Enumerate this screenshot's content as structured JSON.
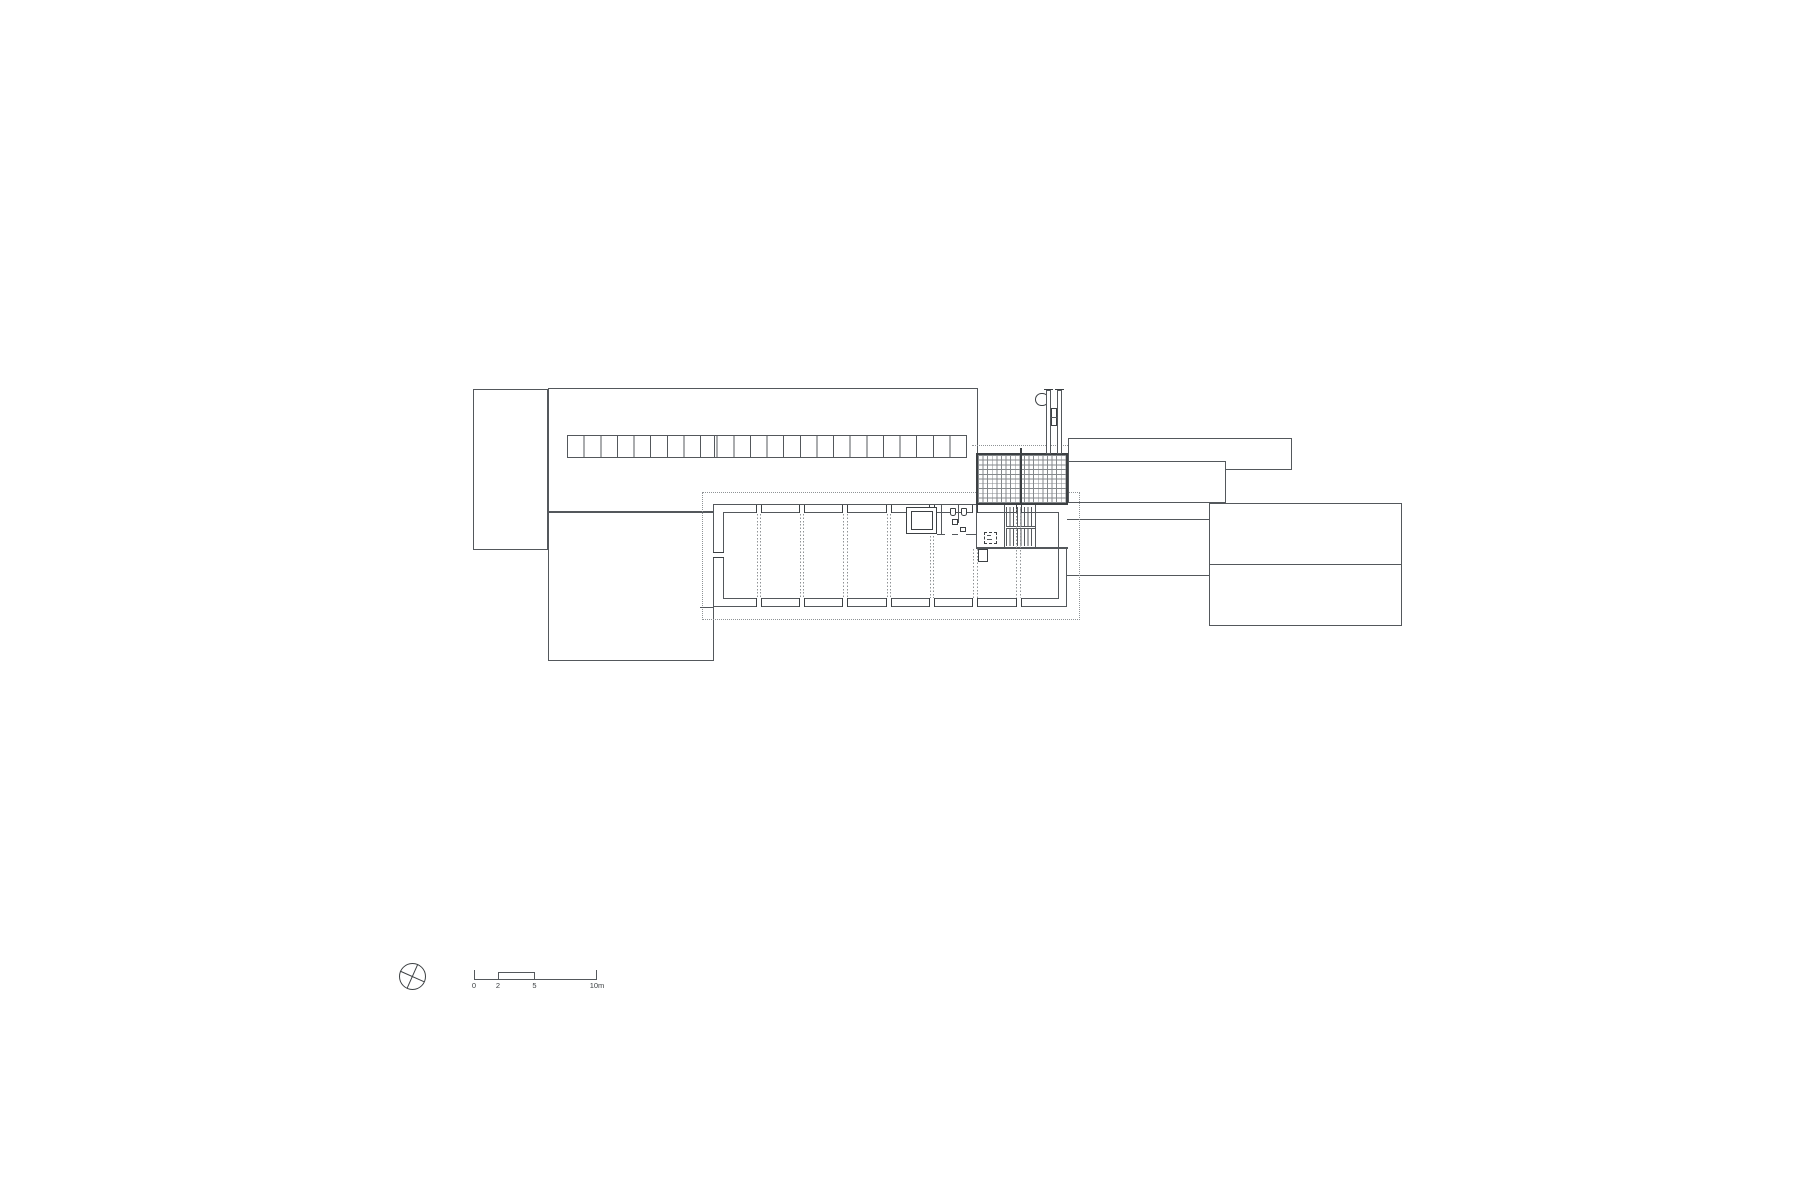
{
  "canvas": {
    "width": 1800,
    "height": 1200,
    "background": "#ffffff"
  },
  "colors": {
    "paper": "#ffffff",
    "line": "#54585c",
    "dark": "#3c4043",
    "dot": "#8f9396",
    "grid": "#85898c"
  },
  "scale_bar": {
    "labels": [
      "0",
      "2",
      "5",
      "10m"
    ]
  },
  "elements": [
    {
      "n": "annex-north-west",
      "t": "rect",
      "x": 473,
      "y": 389,
      "w": 75,
      "h": 161
    },
    {
      "n": "hall-north",
      "t": "rect",
      "x": 548,
      "y": 388,
      "w": 430,
      "h": 124
    },
    {
      "n": "wing-south-west",
      "t": "rect",
      "x": 548,
      "y": 512,
      "w": 166,
      "h": 149
    },
    {
      "n": "strip-north-east",
      "t": "rect",
      "x": 1068,
      "y": 438,
      "w": 224,
      "h": 32
    },
    {
      "n": "link-east",
      "t": "rect",
      "x": 1068,
      "y": 461,
      "w": 158,
      "h": 42
    },
    {
      "n": "building-east",
      "t": "rect",
      "x": 1209,
      "y": 503,
      "w": 193,
      "h": 123
    },
    {
      "n": "building-east-divider",
      "t": "fill",
      "x": 1209,
      "y": 563.5,
      "w": 193,
      "h": 1.2
    },
    {
      "n": "corridor-north-edge",
      "t": "fill",
      "x": 1067,
      "y": 519,
      "w": 142,
      "h": 1.2
    },
    {
      "n": "corridor-south-edge",
      "t": "fill",
      "x": 1067,
      "y": 574.5,
      "w": 142,
      "h": 1.2
    },
    {
      "n": "upper-floor-dashed-outline",
      "t": "dashrect",
      "x": 702,
      "y": 492,
      "w": 378,
      "h": 128
    },
    {
      "n": "hall-south-wall-extension",
      "t": "fill",
      "x": 700,
      "y": 607,
      "w": 14,
      "h": 1
    },
    {
      "n": "floor-plan-outer-wall",
      "t": "rect",
      "x": 713,
      "y": 504,
      "w": 354,
      "h": 103
    },
    {
      "n": "floor-plan-inner-wall",
      "t": "rect",
      "x": 723,
      "y": 512,
      "w": 336,
      "h": 87
    },
    {
      "n": "wall-patch-north",
      "t": "patch",
      "x": 905.5,
      "y": 505,
      "w": 161,
      "h": 6.5
    },
    {
      "n": "wall-patch-east",
      "t": "patch",
      "x": 1058.5,
      "y": 505,
      "w": 8,
      "h": 42
    },
    {
      "n": "column-mark",
      "t": "colv",
      "x": 755.8,
      "y": 504.5,
      "w": 6,
      "h": 8.5
    },
    {
      "n": "column-mark",
      "t": "colv",
      "x": 799.1,
      "y": 504.5,
      "w": 6,
      "h": 8.5
    },
    {
      "n": "column-mark",
      "t": "colv",
      "x": 842.4,
      "y": 504.5,
      "w": 6,
      "h": 8.5
    },
    {
      "n": "column-mark",
      "t": "colv",
      "x": 885.7,
      "y": 504.5,
      "w": 6,
      "h": 8.5
    },
    {
      "n": "column-mark",
      "t": "colv",
      "x": 929,
      "y": 504.5,
      "w": 6,
      "h": 8.5
    },
    {
      "n": "column-mark",
      "t": "colv",
      "x": 972.3,
      "y": 504.5,
      "w": 6,
      "h": 8.5
    },
    {
      "n": "column-mark",
      "t": "colv",
      "x": 1015.6,
      "y": 504.5,
      "w": 6,
      "h": 8.5
    },
    {
      "n": "column-mark",
      "t": "colv",
      "x": 755.8,
      "y": 598,
      "w": 6,
      "h": 8.5
    },
    {
      "n": "column-mark",
      "t": "colv",
      "x": 799.1,
      "y": 598,
      "w": 6,
      "h": 8.5
    },
    {
      "n": "column-mark",
      "t": "colv",
      "x": 842.4,
      "y": 598,
      "w": 6,
      "h": 8.5
    },
    {
      "n": "column-mark",
      "t": "colv",
      "x": 885.7,
      "y": 598,
      "w": 6,
      "h": 8.5
    },
    {
      "n": "column-mark",
      "t": "colv",
      "x": 929,
      "y": 598,
      "w": 6,
      "h": 8.5
    },
    {
      "n": "column-mark",
      "t": "colv",
      "x": 972.3,
      "y": 598,
      "w": 6,
      "h": 8.5
    },
    {
      "n": "column-mark",
      "t": "colv",
      "x": 1015.6,
      "y": 598,
      "w": 6,
      "h": 8.5
    },
    {
      "n": "column-mark-west",
      "t": "colh",
      "x": 713,
      "y": 551.5,
      "w": 10.5,
      "h": 6
    },
    {
      "n": "elevator-shaft-outer",
      "t": "rectb",
      "x": 906,
      "y": 507,
      "w": 31,
      "h": 27
    },
    {
      "n": "elevator-shaft-inner",
      "t": "rectb",
      "x": 910.5,
      "y": 511,
      "w": 22,
      "h": 19
    },
    {
      "n": "wall-elevator-toilet",
      "t": "fill",
      "x": 940.5,
      "y": 505,
      "w": 1.2,
      "h": 29
    },
    {
      "n": "toilet-partition",
      "t": "fill",
      "x": 957.5,
      "y": 505,
      "w": 1.2,
      "h": 18
    },
    {
      "n": "wc-fixture",
      "t": "wc",
      "x": 949.5,
      "y": 507.5,
      "w": 6,
      "h": 8
    },
    {
      "n": "wc-fixture",
      "t": "wc",
      "x": 961,
      "y": 507.5,
      "w": 6,
      "h": 8
    },
    {
      "n": "sink-fixture",
      "t": "sq",
      "x": 951.5,
      "y": 518.5,
      "w": 6.5,
      "h": 6
    },
    {
      "n": "sink-fixture",
      "t": "sq",
      "x": 959.5,
      "y": 526.5,
      "w": 6.5,
      "h": 5
    },
    {
      "n": "toilet-south-wall",
      "t": "fill",
      "x": 937,
      "y": 533.5,
      "w": 7.5,
      "h": 1.2
    },
    {
      "n": "toilet-south-wall",
      "t": "fill",
      "x": 951.5,
      "y": 533.5,
      "w": 6.5,
      "h": 1.2
    },
    {
      "n": "toilet-south-wall",
      "t": "fill",
      "x": 966,
      "y": 533.5,
      "w": 10.5,
      "h": 1.2
    },
    {
      "n": "lobby-west-wall",
      "t": "fill",
      "x": 976,
      "y": 505,
      "w": 1.4,
      "h": 43
    },
    {
      "n": "service-south-wall",
      "t": "fill",
      "x": 976,
      "y": 546.5,
      "w": 91.5,
      "h": 2.4
    },
    {
      "n": "wall-stub",
      "t": "rectb",
      "x": 977.5,
      "y": 549,
      "w": 10.5,
      "h": 13
    },
    {
      "n": "shaft-symbol-dashed",
      "t": "dashsm",
      "x": 984,
      "y": 532,
      "w": 13,
      "h": 12
    },
    {
      "n": "shaft-symbol-mark",
      "t": "fill",
      "x": 986.5,
      "y": 535,
      "w": 4,
      "h": 1.1
    },
    {
      "n": "shaft-symbol-mark",
      "t": "fill",
      "x": 986.5,
      "y": 538.5,
      "w": 5,
      "h": 1.1
    },
    {
      "n": "stair-wall-west",
      "t": "fill",
      "x": 1003.5,
      "y": 505,
      "w": 1.4,
      "h": 42
    },
    {
      "n": "stair-wall-east",
      "t": "fill",
      "x": 1035,
      "y": 505,
      "w": 1.4,
      "h": 42
    },
    {
      "n": "stair-treads-upper",
      "t": "treads",
      "x": 1005.5,
      "y": 507,
      "w": 29.5,
      "h": 18.5,
      "p": 3.6
    },
    {
      "n": "stair-treads-lower",
      "t": "treads",
      "x": 1005.5,
      "y": 528.5,
      "w": 29.5,
      "h": 17.5,
      "p": 3.6
    },
    {
      "n": "stair-landing-line",
      "t": "fill",
      "x": 1005.5,
      "y": 525.6,
      "w": 29.5,
      "h": 1
    },
    {
      "n": "stair-landing-line",
      "t": "fill",
      "x": 1005.5,
      "y": 528,
      "w": 29.5,
      "h": 1
    },
    {
      "n": "column-axis-dotted",
      "t": "dotv",
      "x": 756.6,
      "y": 514,
      "w": 1,
      "h": 84
    },
    {
      "n": "column-axis-dotted",
      "t": "dotv",
      "x": 760,
      "y": 514,
      "w": 1,
      "h": 84
    },
    {
      "n": "column-axis-dotted",
      "t": "dotv",
      "x": 799.9,
      "y": 514,
      "w": 1,
      "h": 84
    },
    {
      "n": "column-axis-dotted",
      "t": "dotv",
      "x": 803.3,
      "y": 514,
      "w": 1,
      "h": 84
    },
    {
      "n": "column-axis-dotted",
      "t": "dotv",
      "x": 843.2,
      "y": 514,
      "w": 1,
      "h": 84
    },
    {
      "n": "column-axis-dotted",
      "t": "dotv",
      "x": 846.6,
      "y": 514,
      "w": 1,
      "h": 84
    },
    {
      "n": "column-axis-dotted",
      "t": "dotv",
      "x": 886.5,
      "y": 514,
      "w": 1,
      "h": 84
    },
    {
      "n": "column-axis-dotted",
      "t": "dotv",
      "x": 889.9,
      "y": 514,
      "w": 1,
      "h": 84
    },
    {
      "n": "column-axis-dotted",
      "t": "dotv",
      "x": 929.8,
      "y": 536,
      "w": 1,
      "h": 62
    },
    {
      "n": "column-axis-dotted",
      "t": "dotv",
      "x": 933.2,
      "y": 536,
      "w": 1,
      "h": 62
    },
    {
      "n": "column-axis-dotted",
      "t": "dotv",
      "x": 973.1,
      "y": 549,
      "w": 1,
      "h": 49
    },
    {
      "n": "column-axis-dotted",
      "t": "dotv",
      "x": 976.5,
      "y": 549,
      "w": 1,
      "h": 49
    },
    {
      "n": "column-axis-dotted",
      "t": "dotv",
      "x": 1016.4,
      "y": 509,
      "w": 1,
      "h": 89
    },
    {
      "n": "column-axis-dotted",
      "t": "dotv",
      "x": 1019.8,
      "y": 509,
      "w": 1,
      "h": 89
    },
    {
      "n": "roof-glazing-grid",
      "t": "grid",
      "x": 976,
      "y": 453,
      "w": 92,
      "h": 52,
      "px": 4.6,
      "py": 4.72
    },
    {
      "n": "roof-glazing-mullion",
      "t": "filld",
      "x": 1019.5,
      "y": 448,
      "w": 2.2,
      "h": 57
    },
    {
      "n": "roof-dashed-edge",
      "t": "dashh",
      "x": 972,
      "y": 445,
      "w": 96,
      "h": 2
    },
    {
      "n": "skylight-band",
      "t": "stripes",
      "x": 567,
      "y": 435,
      "w": 400,
      "h": 23,
      "p": 16.63
    },
    {
      "n": "skylight-divider",
      "t": "fill",
      "x": 714,
      "y": 435.5,
      "w": 1,
      "h": 22
    },
    {
      "n": "chimney-hoop",
      "t": "circle",
      "x": 1035,
      "y": 392.5,
      "w": 13.5,
      "h": 13.5
    },
    {
      "n": "chimney-rail-west",
      "t": "rect",
      "x": 1045.5,
      "y": 390,
      "w": 5.5,
      "h": 63.5
    },
    {
      "n": "chimney-rail-east",
      "t": "rect",
      "x": 1056.5,
      "y": 390,
      "w": 5.5,
      "h": 63.5
    },
    {
      "n": "chimney-cap",
      "t": "filld",
      "x": 1043.5,
      "y": 388.6,
      "w": 9,
      "h": 1.6
    },
    {
      "n": "chimney-cap",
      "t": "filld",
      "x": 1054.5,
      "y": 388.6,
      "w": 9.5,
      "h": 1.6
    },
    {
      "n": "chimney-flue",
      "t": "sq",
      "x": 1051,
      "y": 408,
      "w": 5.5,
      "h": 18
    },
    {
      "n": "chimney-flue-divider",
      "t": "fill",
      "x": 1051,
      "y": 416.5,
      "w": 5.5,
      "h": 1
    },
    {
      "n": "north-symbol-circle",
      "t": "circle",
      "x": 399,
      "y": 963,
      "w": 27,
      "h": 27
    },
    {
      "n": "north-needle",
      "t": "rot",
      "x": 399.3,
      "y": 975.9,
      "w": 26.4,
      "h": 1.2,
      "a": 24
    },
    {
      "n": "north-needle",
      "t": "rot",
      "x": 399.3,
      "y": 975.9,
      "w": 26.4,
      "h": 1.2,
      "a": 114
    },
    {
      "n": "scale-bar-baseline",
      "t": "fill",
      "x": 474,
      "y": 978.8,
      "w": 123,
      "h": 1.2
    },
    {
      "n": "scale-bar-tick",
      "t": "fill",
      "x": 474,
      "y": 969.5,
      "w": 1.2,
      "h": 10.5
    },
    {
      "n": "scale-bar-tick",
      "t": "fill",
      "x": 595.8,
      "y": 969.5,
      "w": 1.2,
      "h": 10.5
    },
    {
      "n": "scale-bar-step",
      "t": "fill",
      "x": 498,
      "y": 971.6,
      "w": 1.2,
      "h": 8.4
    },
    {
      "n": "scale-bar-step",
      "t": "fill",
      "x": 534,
      "y": 971.6,
      "w": 1.2,
      "h": 8.4
    },
    {
      "n": "scale-bar-step-top",
      "t": "fill",
      "x": 498,
      "y": 971.6,
      "w": 37.2,
      "h": 1.2
    }
  ]
}
